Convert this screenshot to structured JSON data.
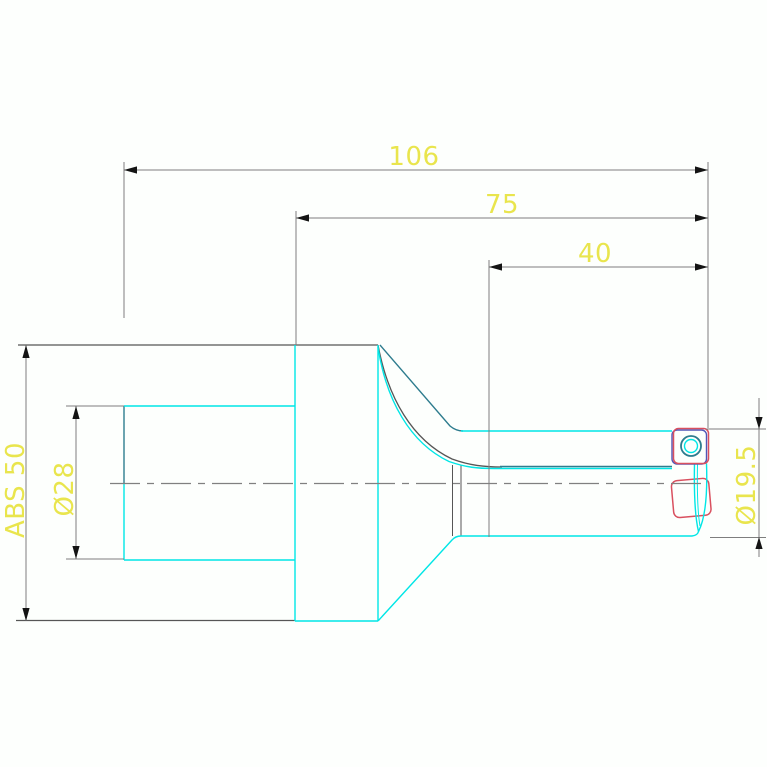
{
  "page": {
    "background": "#fdfffd",
    "description_visible_text_only": "CAD side view of an indexable insert drill with ABS coupling"
  },
  "colors": {
    "dimension_gray": "#7e7e7e",
    "outline_gray": "#565656",
    "part_cyan": "#00e6e6",
    "part_teal": "#2e7c8e",
    "insert_red": "#d9505f",
    "insert_blue": "#5156b8",
    "label_yellow": "#e9e54d",
    "arrow_black": "#141414",
    "centerline_gray": "#808080"
  },
  "dimensions": {
    "overall_length": {
      "label": "106"
    },
    "body_length": {
      "label": "75"
    },
    "flute_length": {
      "label": "40"
    },
    "coupling_size": {
      "label": "ABS 50"
    },
    "bore_diameter": {
      "label": "Ø28"
    },
    "neck_diameter": {
      "label": "Ø19.5"
    }
  }
}
